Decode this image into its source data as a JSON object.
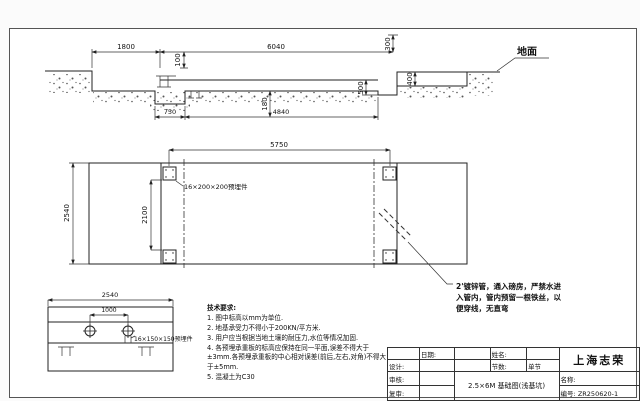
{
  "section_view": {
    "ground_label": "地面",
    "dims": {
      "d1800": "1800",
      "d6040": "6040",
      "d100": "100",
      "d300": "300",
      "d400": "400",
      "d500": "500",
      "d180": "180",
      "d750": "750",
      "d4840": "4840"
    }
  },
  "plan_view": {
    "dims": {
      "d5750": "5750",
      "d2540": "2540",
      "d2100": "2100"
    },
    "plate_label": "16×200×200预埋件",
    "pipe_note_line1": "2'镀锌管，通入磅房，严禁水进",
    "pipe_note_line2": "入管内，管内预留一根铁丝，以",
    "pipe_note_line3": "便穿线，无直弯"
  },
  "end_view": {
    "dims": {
      "d2540": "2540",
      "d1000": "1000"
    },
    "plate_label": "16×150×150预埋件"
  },
  "tech_requirements": {
    "title": "技术要求:",
    "items": [
      "1. 图中标高以mm为单位.",
      "2. 地基承受力不得小于200KN/平方米.",
      "3. 用户应当根据当地土壤的耐压力,水位等情况加固.",
      "4. 各预埋承重板的标高应保持在同一平面,误差不得大于±3mm.各预埋承重板的中心相对误差(前后,左右,对角)不得大于±5mm.",
      "5. 混凝土为C30"
    ]
  },
  "title_block": {
    "date_label": "日期:",
    "name_label": "姓名:",
    "design_label": "设计:",
    "review_label": "审核:",
    "recheck_label": "复审:",
    "sections_label": "节数:",
    "sections_value": "单节",
    "drawing_title": "2.5×6M 基础图(浅基坑)",
    "company": "上海志荣",
    "title_label": "名称:",
    "number_label": "编号:",
    "number_value": "ZR250620-1"
  }
}
